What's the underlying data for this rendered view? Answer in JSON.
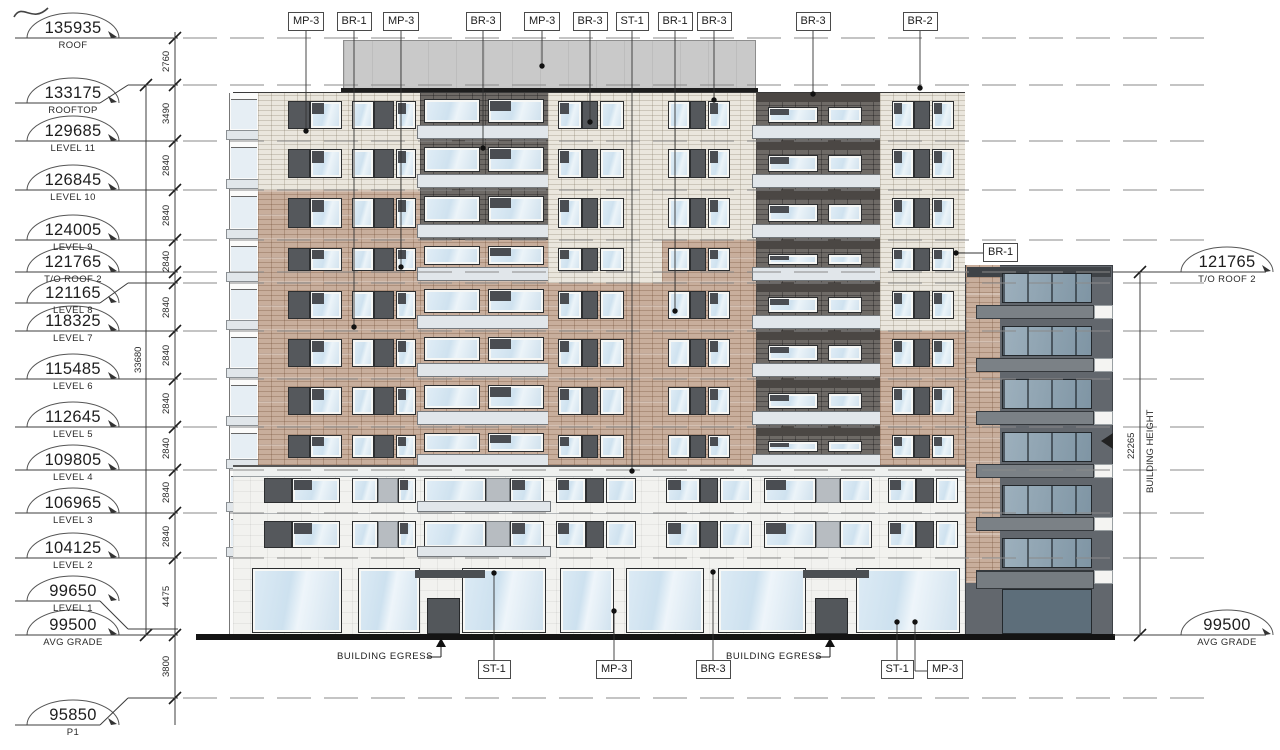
{
  "title": "Building Elevation",
  "left_levels": [
    {
      "value": "135935",
      "name": "ROOF",
      "label_y": 38,
      "line_y": 38,
      "jog": false
    },
    {
      "value": "133175",
      "name": "ROOFTOP",
      "label_y": 103,
      "line_y": 85,
      "jog": true
    },
    {
      "value": "129685",
      "name": "LEVEL 11",
      "label_y": 141,
      "line_y": 141,
      "jog": false
    },
    {
      "value": "126845",
      "name": "LEVEL 10",
      "label_y": 190,
      "line_y": 190,
      "jog": false
    },
    {
      "value": "124005",
      "name": "LEVEL 9",
      "label_y": 240,
      "line_y": 240,
      "jog": false
    },
    {
      "value": "121765",
      "name": "T/O ROOF 2",
      "label_y": 272,
      "line_y": 272,
      "jog": false
    },
    {
      "value": "121165",
      "name": "LEVEL 8",
      "label_y": 303,
      "line_y": 283,
      "jog": true
    },
    {
      "value": "118325",
      "name": "LEVEL 7",
      "label_y": 331,
      "line_y": 331,
      "jog": false
    },
    {
      "value": "115485",
      "name": "LEVEL 6",
      "label_y": 379,
      "line_y": 379,
      "jog": false
    },
    {
      "value": "112645",
      "name": "LEVEL 5",
      "label_y": 427,
      "line_y": 427,
      "jog": false
    },
    {
      "value": "109805",
      "name": "LEVEL 4",
      "label_y": 470,
      "line_y": 470,
      "jog": false
    },
    {
      "value": "106965",
      "name": "LEVEL 3",
      "label_y": 513,
      "line_y": 513,
      "jog": false
    },
    {
      "value": "104125",
      "name": "LEVEL 2",
      "label_y": 558,
      "line_y": 558,
      "jog": false
    },
    {
      "value": "99650",
      "name": "LEVEL 1",
      "label_y": 601,
      "line_y": 629,
      "jog": true
    },
    {
      "value": "99500",
      "name": "AVG GRADE",
      "label_y": 635,
      "line_y": 635,
      "jog": false
    },
    {
      "value": "95850",
      "name": "P1",
      "label_y": 725,
      "line_y": 698,
      "jog": true
    }
  ],
  "right_levels": [
    {
      "value": "121765",
      "name": "T/O ROOF 2",
      "label_y": 272
    },
    {
      "value": "99500",
      "name": "AVG GRADE",
      "label_y": 635
    }
  ],
  "left_dims": [
    {
      "value": "2760",
      "y": 61
    },
    {
      "value": "3490",
      "y": 113
    },
    {
      "value": "2840",
      "y": 165
    },
    {
      "value": "2840",
      "y": 215
    },
    {
      "value": "2840",
      "y": 261
    },
    {
      "value": "2840",
      "y": 307
    },
    {
      "value": "2840",
      "y": 355
    },
    {
      "value": "2840",
      "y": 403
    },
    {
      "value": "2840",
      "y": 448
    },
    {
      "value": "2840",
      "y": 492
    },
    {
      "value": "2840",
      "y": 536
    },
    {
      "value": "4475",
      "y": 596
    },
    {
      "value": "3800",
      "y": 666
    }
  ],
  "overall_dim": {
    "value": "33680",
    "x": 146,
    "y": 360
  },
  "right_dim": {
    "value": "22265",
    "label": "BUILDING HEIGHT",
    "x": 1140,
    "top": 272,
    "bottom": 635
  },
  "top_tags": [
    {
      "label": "MP-3",
      "cx": 306,
      "end_y": 131
    },
    {
      "label": "BR-1",
      "cx": 354,
      "end_y": 327
    },
    {
      "label": "MP-3",
      "cx": 401,
      "end_y": 267
    },
    {
      "label": "BR-3",
      "cx": 483,
      "end_y": 148
    },
    {
      "label": "MP-3",
      "cx": 542,
      "end_y": 66
    },
    {
      "label": "BR-3",
      "cx": 590,
      "end_y": 122
    },
    {
      "label": "ST-1",
      "cx": 632,
      "end_y": 471
    },
    {
      "label": "BR-1",
      "cx": 675,
      "end_y": 311
    },
    {
      "label": "BR-3",
      "cx": 714,
      "end_y": 100
    },
    {
      "label": "BR-3",
      "cx": 813,
      "end_y": 94
    },
    {
      "label": "BR-2",
      "cx": 920,
      "end_y": 88
    }
  ],
  "bottom_tags": [
    {
      "label": "ST-1",
      "cx": 494,
      "end_y": 573,
      "jog_x": 0
    },
    {
      "label": "MP-3",
      "cx": 614,
      "end_y": 611,
      "jog_x": 0
    },
    {
      "label": "BR-3",
      "cx": 713,
      "end_y": 572,
      "jog_x": 0
    },
    {
      "label": "ST-1",
      "cx": 897,
      "end_y": 622,
      "jog_x": 0
    },
    {
      "label": "MP-3",
      "cx": 945,
      "end_y": 622,
      "jog_x": 915
    }
  ],
  "side_tags": [
    {
      "label": "BR-1",
      "box_x": 983,
      "box_y": 243,
      "end_x": 956,
      "end_y": 253
    }
  ],
  "egress_labels": [
    {
      "text": "BUILDING EGRESS",
      "x": 340,
      "y": 651,
      "arrow_x": 441
    },
    {
      "text": "BUILDING EGRESS",
      "x": 731,
      "y": 651,
      "arrow_x": 830
    }
  ],
  "grid_lines": [
    38,
    85,
    141,
    190,
    240,
    272,
    283,
    331,
    379,
    427,
    470,
    513,
    558,
    698
  ],
  "palette": {
    "cream": "#eae6dd",
    "tan": "#c8ae9c",
    "dark_brick": "#6e6a66",
    "dark_header": "#4b4744",
    "panel_dark": "#55585c",
    "panel_gray": "#b7bcc1",
    "glass": "#d7e7f2",
    "glass_dark": "#8fa3b2",
    "slab": "#e1e6ea",
    "wing_body": "#62676d",
    "wing_slab": "#7b8186",
    "roof_band": "#c9c9c9",
    "podium": "#f2f2ef",
    "line": "#4a4a4a",
    "grade": "#141414"
  }
}
